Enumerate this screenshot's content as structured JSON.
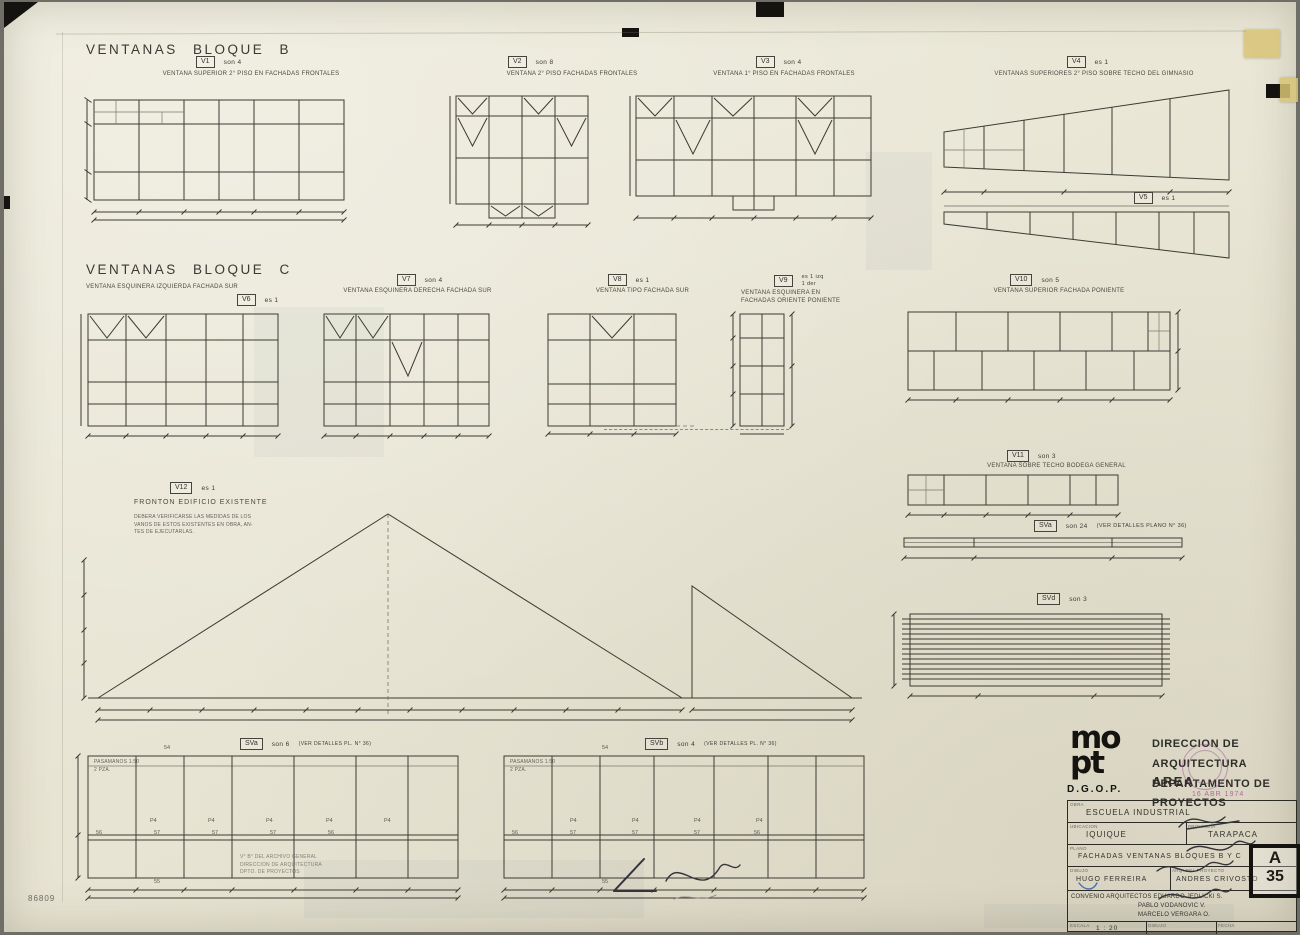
{
  "page": {
    "b_title": "VENTANAS BLOQUE B",
    "c_title": "VENTANAS BLOQUE C",
    "sheet_pencil_number": "86809"
  },
  "windows": {
    "v1": {
      "tag": "V1",
      "count": "son 4",
      "caption": "VENTANA SUPERIOR 2° PISO EN FACHADAS FRONTALES"
    },
    "v2": {
      "tag": "V2",
      "count": "son 8",
      "caption": "VENTANA 2° PISO FACHADAS FRONTALES"
    },
    "v3": {
      "tag": "V3",
      "count": "son 4",
      "caption": "VENTANA 1° PISO EN FACHADAS FRONTALES"
    },
    "v4": {
      "tag": "V4",
      "count": "es 1",
      "caption": "VENTANAS SUPERIORES 2° PISO SOBRE TECHO DEL GIMNASIO"
    },
    "v5": {
      "tag": "V5",
      "count": "es 1",
      "caption": ""
    },
    "v6": {
      "tag": "V6",
      "count": "es 1",
      "caption": "VENTANA ESQUINERA IZQUIERDA FACHADA SUR"
    },
    "v7": {
      "tag": "V7",
      "count": "son 4",
      "caption": "VENTANA ESQUINERA DERECHA FACHADA SUR"
    },
    "v8": {
      "tag": "V8",
      "count": "es 1",
      "caption": "VENTANA TIPO FACHADA SUR"
    },
    "v9": {
      "tag": "V9",
      "count": "es 1 izq\n1 der",
      "caption": "VENTANA ESQUINERA EN\nFACHADAS ORIENTE PONIENTE"
    },
    "v10": {
      "tag": "V10",
      "count": "son 5",
      "caption": "VENTANA SUPERIOR FACHADA PONIENTE"
    },
    "v11": {
      "tag": "V11",
      "count": "son 3",
      "caption": "VENTANA SOBRE TECHO BODEGA GENERAL"
    },
    "v12": {
      "tag": "V12",
      "count": "es 1",
      "caption": "FRONTON EDIFICIO EXISTENTE",
      "note": "DEBERA VERIFICARSE LAS MEDIDAS DE LOS\nVANOS DE ESTOS EXISTENTES EN OBRA, AN-\nTES DE EJECUTARLAS."
    },
    "sva24": {
      "tag": "SVa",
      "count": "son 24",
      "caption": "(VER DETALLES PLANO N° 36)"
    },
    "svd": {
      "tag": "SVd",
      "count": "son 3",
      "caption": ""
    },
    "sva6": {
      "tag": "SVa",
      "count": "son 6",
      "caption": "(VER DETALLES PL. N° 36)"
    },
    "svb4": {
      "tag": "SVb",
      "count": "son 4",
      "caption": "(VER DETALLES PL. N° 36)"
    }
  },
  "bottom_panels": {
    "note_line1": "PASAMANOS 1.50",
    "note_line2": "2 PZA.",
    "top_dim": "54",
    "bottom_dim": "55",
    "mid_dims": [
      "56",
      "57",
      "57",
      "57",
      "56"
    ],
    "pane_codes": [
      "P4",
      "P4",
      "P4",
      "P4",
      "P4"
    ]
  },
  "title_block": {
    "logo_top": "mo",
    "logo_bottom": "pt",
    "logo_sub": "D.G.O.P.",
    "agency_line1": "DIRECCION DE ARQUITECTURA",
    "agency_line2": "DEPARTAMENTO DE PROYECTOS",
    "area": "AREA",
    "date_stamp": "16 ABR 1974",
    "obra_label": "OBRA",
    "obra": "ESCUELA INDUSTRIAL",
    "ubicacion_label": "UBICACION",
    "ubicacion": "IQUIQUE",
    "provincia_label": "PROVINCIA",
    "provincia": "TARAPACA",
    "plano_label": "PLANO",
    "plano": "FACHADAS VENTANAS BLOQUES B Y C",
    "dibujo_label": "DIBUJO",
    "dibujo": "HUGO FERREIRA",
    "arquitecto_label": "ARQ. DEL PROYECTO",
    "arquitecto": "ANDRES CRIVOSTO",
    "convenio_line1": "CONVENIO ARQUITECTOS EDUARDO JEDLICKI S.",
    "convenio_line2": "PABLO VODANOVIC V.",
    "convenio_line3": "MARCELO VERGARA O.",
    "escala_label": "ESCALA",
    "escala": "1 : 20",
    "dibujante_label": "DIBUJO",
    "fecha_label": "FECHA",
    "lamina_letter": "A",
    "lamina_number": "35"
  },
  "stamps": {
    "archive_line1": "V° B° DEL ARCHIVO GENERAL",
    "archive_line2": "DIRECCION DE ARQUITECTURA",
    "archive_line3": "DPTO. DE PROYECTOS"
  }
}
